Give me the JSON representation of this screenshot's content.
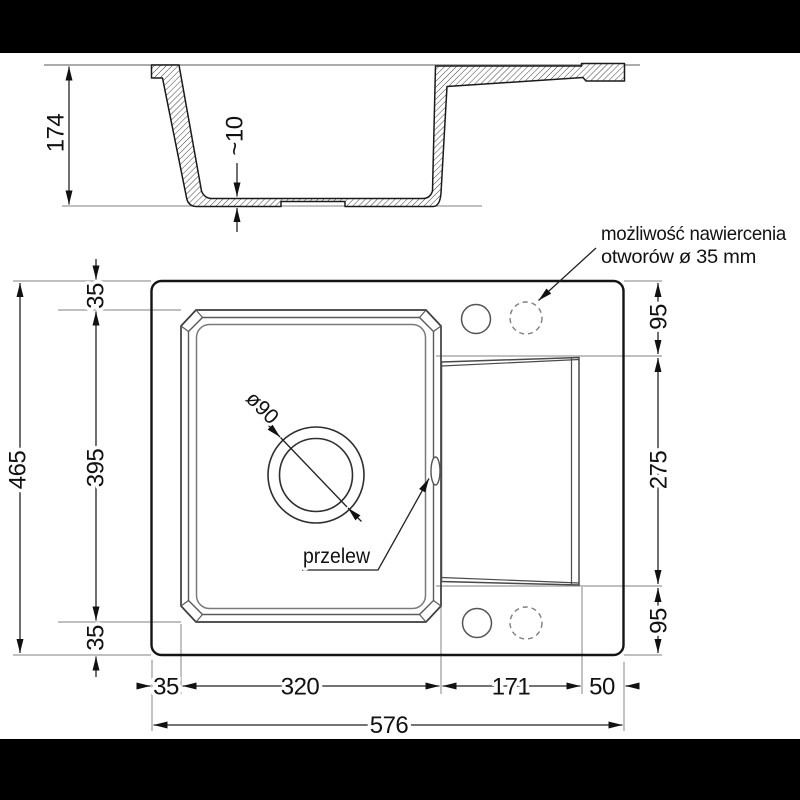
{
  "meta": {
    "bg_bar_color": "#000000",
    "line_color": "#1a1a1a"
  },
  "section_view": {
    "dim_depth": "174",
    "dim_bottom_thickness": "~10"
  },
  "plan_view": {
    "dims": {
      "total_height": "465",
      "top_offset": "35",
      "bowl_height": "395",
      "bottom_offset": "35",
      "left_offset": "35",
      "bowl_width": "320",
      "board_width": "171",
      "right_offset": "50",
      "total_width": "576",
      "board_top_offset": "95",
      "board_height": "275",
      "board_bottom_offset": "95",
      "drain_diameter": "ø90"
    },
    "labels": {
      "overflow": "przelew",
      "drill_note_line1": "możliwość nawiercenia",
      "drill_note_line2": "otworów ø 35 mm"
    }
  }
}
